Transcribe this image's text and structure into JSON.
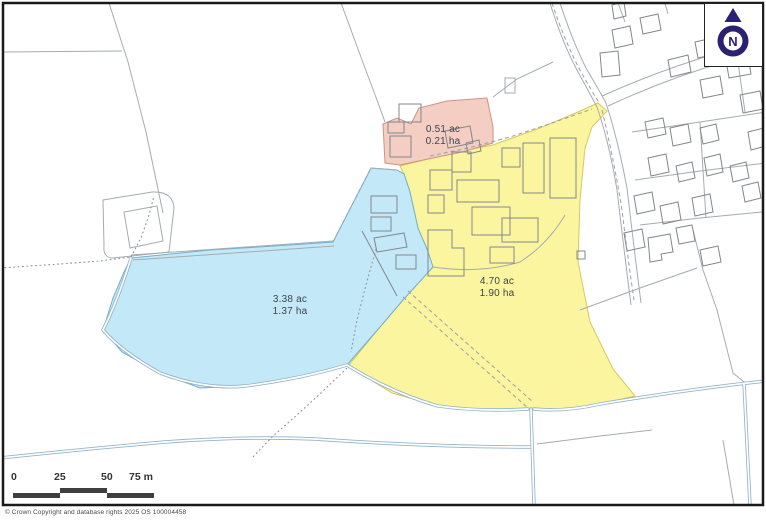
{
  "map_type": "property-boundary-plan",
  "north": {
    "label": "N"
  },
  "parcels": {
    "blue": {
      "area_acres": "3.38 ac",
      "area_hectares": "1.37 ha"
    },
    "yellow": {
      "area_acres": "4.70 ac",
      "area_hectares": "1.90 ha"
    },
    "pink": {
      "area_acres": "0.51 ac",
      "area_hectares": "0.21 ha"
    }
  },
  "scale_bar": {
    "labels": [
      "0",
      "25",
      "50",
      "75 m"
    ]
  },
  "copyright": "© Crown Copyright and database rights 2025 OS 100004458",
  "colors": {
    "parcel-blue": "#c3e9f8",
    "parcel-blue-stroke": "#6fb0d2",
    "parcel-yellow": "#fbf5a0",
    "parcel-yellow-stroke": "#d6c95e",
    "parcel-pink": "#f4cec2",
    "parcel-pink-stroke": "#cf9280",
    "base-line": "#a6abb0",
    "building-line": "#83878b",
    "stream-line": "#93b3c7",
    "north-navy": "#2b2171",
    "scalebar": "#3f3f3f",
    "label-text": "#3d4450",
    "frame": "#1a1a1a",
    "copyright-text": "#4a4a4a"
  }
}
